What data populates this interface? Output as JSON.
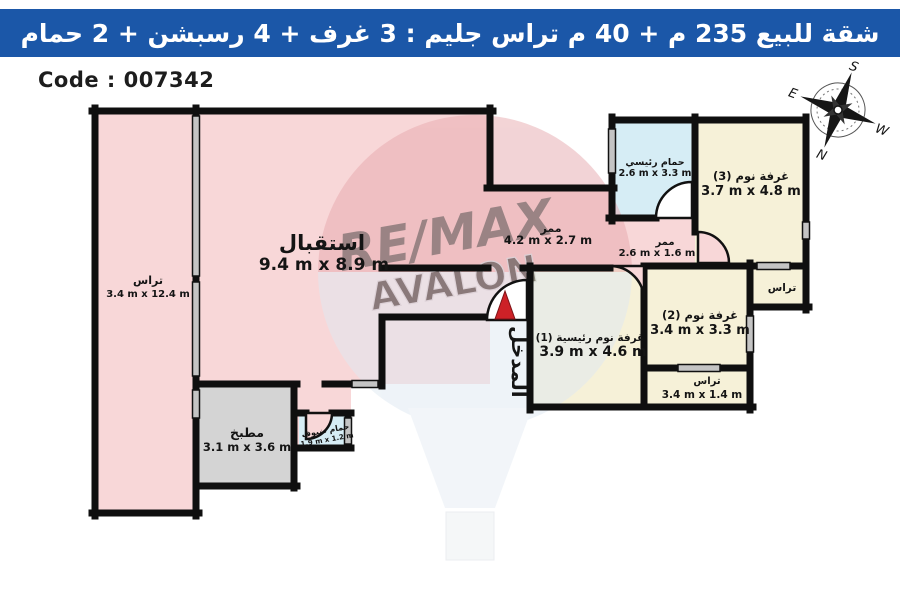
{
  "title_bar": {
    "text": "شقة للبيع 235 م + 40 م تراس جليم :  3 غرف + 4 رسبشن + 2 حمام",
    "bg_color": "#1b57a8"
  },
  "code_label": "Code : 007342",
  "watermark": {
    "line1": "RE/MAX",
    "line2": "AVALON"
  },
  "compass": {
    "n": "N",
    "s": "S",
    "e": "E",
    "w": "W"
  },
  "entrance": {
    "label": "المدخل",
    "arrow_color": "#cd2127"
  },
  "colors": {
    "wall": "#0f0f0f",
    "room_pink": "#f8d7d8",
    "room_cream": "#f6f1d8",
    "room_cyan": "#d6edf5",
    "room_gray": "#d4d4d4",
    "window_gray": "#c4c4c4"
  },
  "rooms": [
    {
      "id": "reception",
      "name": "استقبال",
      "dims": "9.4 m x 8.9 m"
    },
    {
      "id": "terrace-left",
      "name": "تراس",
      "dims": "3.4 m x 12.4 m"
    },
    {
      "id": "kitchen",
      "name": "مطبخ",
      "dims": "3.1 m x 3.6 m"
    },
    {
      "id": "guest-bath",
      "name": "حمام ضيوف",
      "dims": "1.9 m x 1.2 m"
    },
    {
      "id": "corridor-a",
      "name": "ممر",
      "dims": "4.2 m x 2.7 m"
    },
    {
      "id": "corridor-b",
      "name": "ممر",
      "dims": "2.6 m x 1.6 m"
    },
    {
      "id": "master-bath",
      "name": "حمام رئيسي",
      "dims": "2.6 m x 3.3 m"
    },
    {
      "id": "bedroom-3",
      "name": "غرفة نوم (3)",
      "dims": "3.7 m x 4.8 m"
    },
    {
      "id": "bedroom-2",
      "name": "غرفة نوم (2)",
      "dims": "3.4 m x 3.3 m"
    },
    {
      "id": "master-bedroom",
      "name": "غرفة نوم رئيسية (1)",
      "dims": "3.9 m x 4.6 m"
    },
    {
      "id": "terrace-bottom",
      "name": "تراس",
      "dims": "3.4 m x 1.4 m"
    },
    {
      "id": "terrace-right",
      "name": "تراس",
      "dims": ""
    }
  ]
}
